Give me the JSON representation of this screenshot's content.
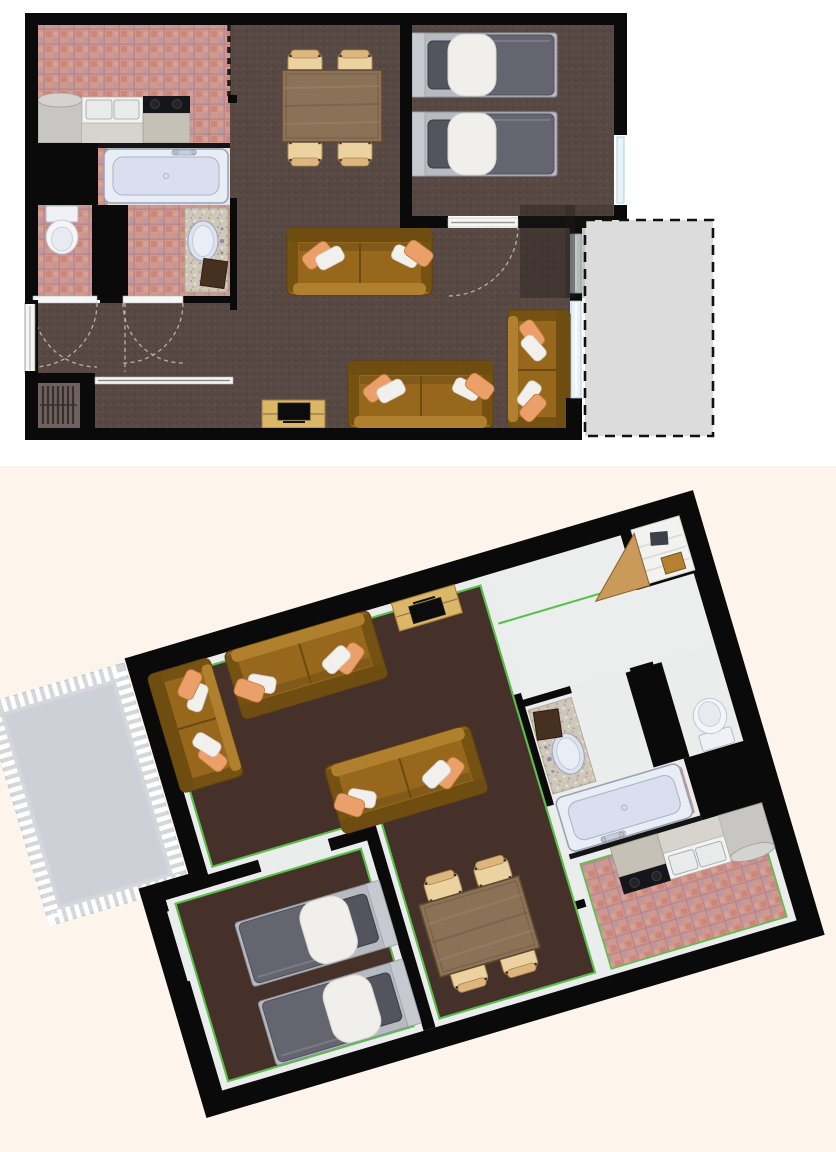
{
  "document": {
    "title": "Apartment floor plan preview",
    "views": [
      {
        "id": "plan-2d",
        "label": "2D top-down floor plan",
        "position": "top"
      },
      {
        "id": "plan-3d",
        "label": "3D aerial view (rotated)",
        "position": "bottom"
      }
    ]
  },
  "apartment": {
    "rooms": [
      {
        "name": "Kitchen",
        "floor": "pink ceramic tile",
        "features": [
          "refrigerator",
          "sink counter",
          "cooktop"
        ]
      },
      {
        "name": "Bathroom",
        "floor": "tile",
        "features": [
          "bathtub with faucet"
        ]
      },
      {
        "name": "Toilet room",
        "floor": "pink ceramic tile",
        "features": [
          "toilet"
        ]
      },
      {
        "name": "Washroom",
        "floor": "pink ceramic tile",
        "features": [
          "granite vanity with oval sink",
          "dark towel"
        ]
      },
      {
        "name": "Hallway",
        "floor": "carpet",
        "features": [
          "two swing doors with dashed arcs"
        ]
      },
      {
        "name": "Entry",
        "floor": "vinyl",
        "features": [
          "shoe shelf",
          "front door"
        ]
      },
      {
        "name": "Living / dining room",
        "floor": "dark brown carpet",
        "features": [
          "loveseat sofa",
          "three-seat sofa",
          "two-seat sofa",
          "TV stand with television",
          "dining table with four chairs",
          "sliding glass windows"
        ]
      },
      {
        "name": "Bedroom",
        "floor": "dark brown carpet",
        "features": [
          "two single beds",
          "window"
        ]
      },
      {
        "name": "Balcony",
        "floor": "concrete",
        "features": [
          "dashed boundary (2D)",
          "white railing (3D)"
        ]
      }
    ],
    "furniture": [
      "refrigerator",
      "kitchen-sink-counter",
      "cooktop",
      "bathtub",
      "toilet",
      "vanity-sink",
      "towel",
      "dining-table",
      "dining-chair-1",
      "dining-chair-2",
      "dining-chair-3",
      "dining-chair-4",
      "loveseat-sofa",
      "three-seat-sofa",
      "two-seat-sofa",
      "tv-stand",
      "television",
      "single-bed-1",
      "single-bed-2",
      "shoe-shelf",
      "wooden-crate",
      "open-wood-door"
    ]
  },
  "colors": {
    "wall": "#0a0a0a",
    "carpet2d": "#584944",
    "carpet3d": "#46312a",
    "hall2d": "#5d4f4a",
    "genkan": "#6e6260",
    "tileBase": "#d0998d",
    "tileLine": "#b08391",
    "balcony2d": "#dcdcdc",
    "balcony3d": "#d5d7db",
    "sofa": "#97681c",
    "sofaDark": "#6f4d10",
    "sofaLight": "#b0802e",
    "pillowOrange": "#eba06a",
    "pillowWhite": "#f2f0ed",
    "tableWood": "#8b7156",
    "chair": "#ecd2a0",
    "tvStand": "#ddb768",
    "duvet": "#64656f",
    "blanket": "#f0efec",
    "mattress": "#b7bac1",
    "headboard": "#c6c9cf",
    "pillowDark": "#53545e",
    "fixture": "#e9edf5",
    "fixtureInner": "#d9dfee",
    "glass": "#e6f3f9",
    "granite": "#cfc8ba",
    "towel": "#46301f",
    "cream": "#fdf5ec",
    "green": "#5abf4d",
    "white3d": "#ebecec",
    "woodDoor": "#c99a5a",
    "crate": "#b5802f"
  }
}
